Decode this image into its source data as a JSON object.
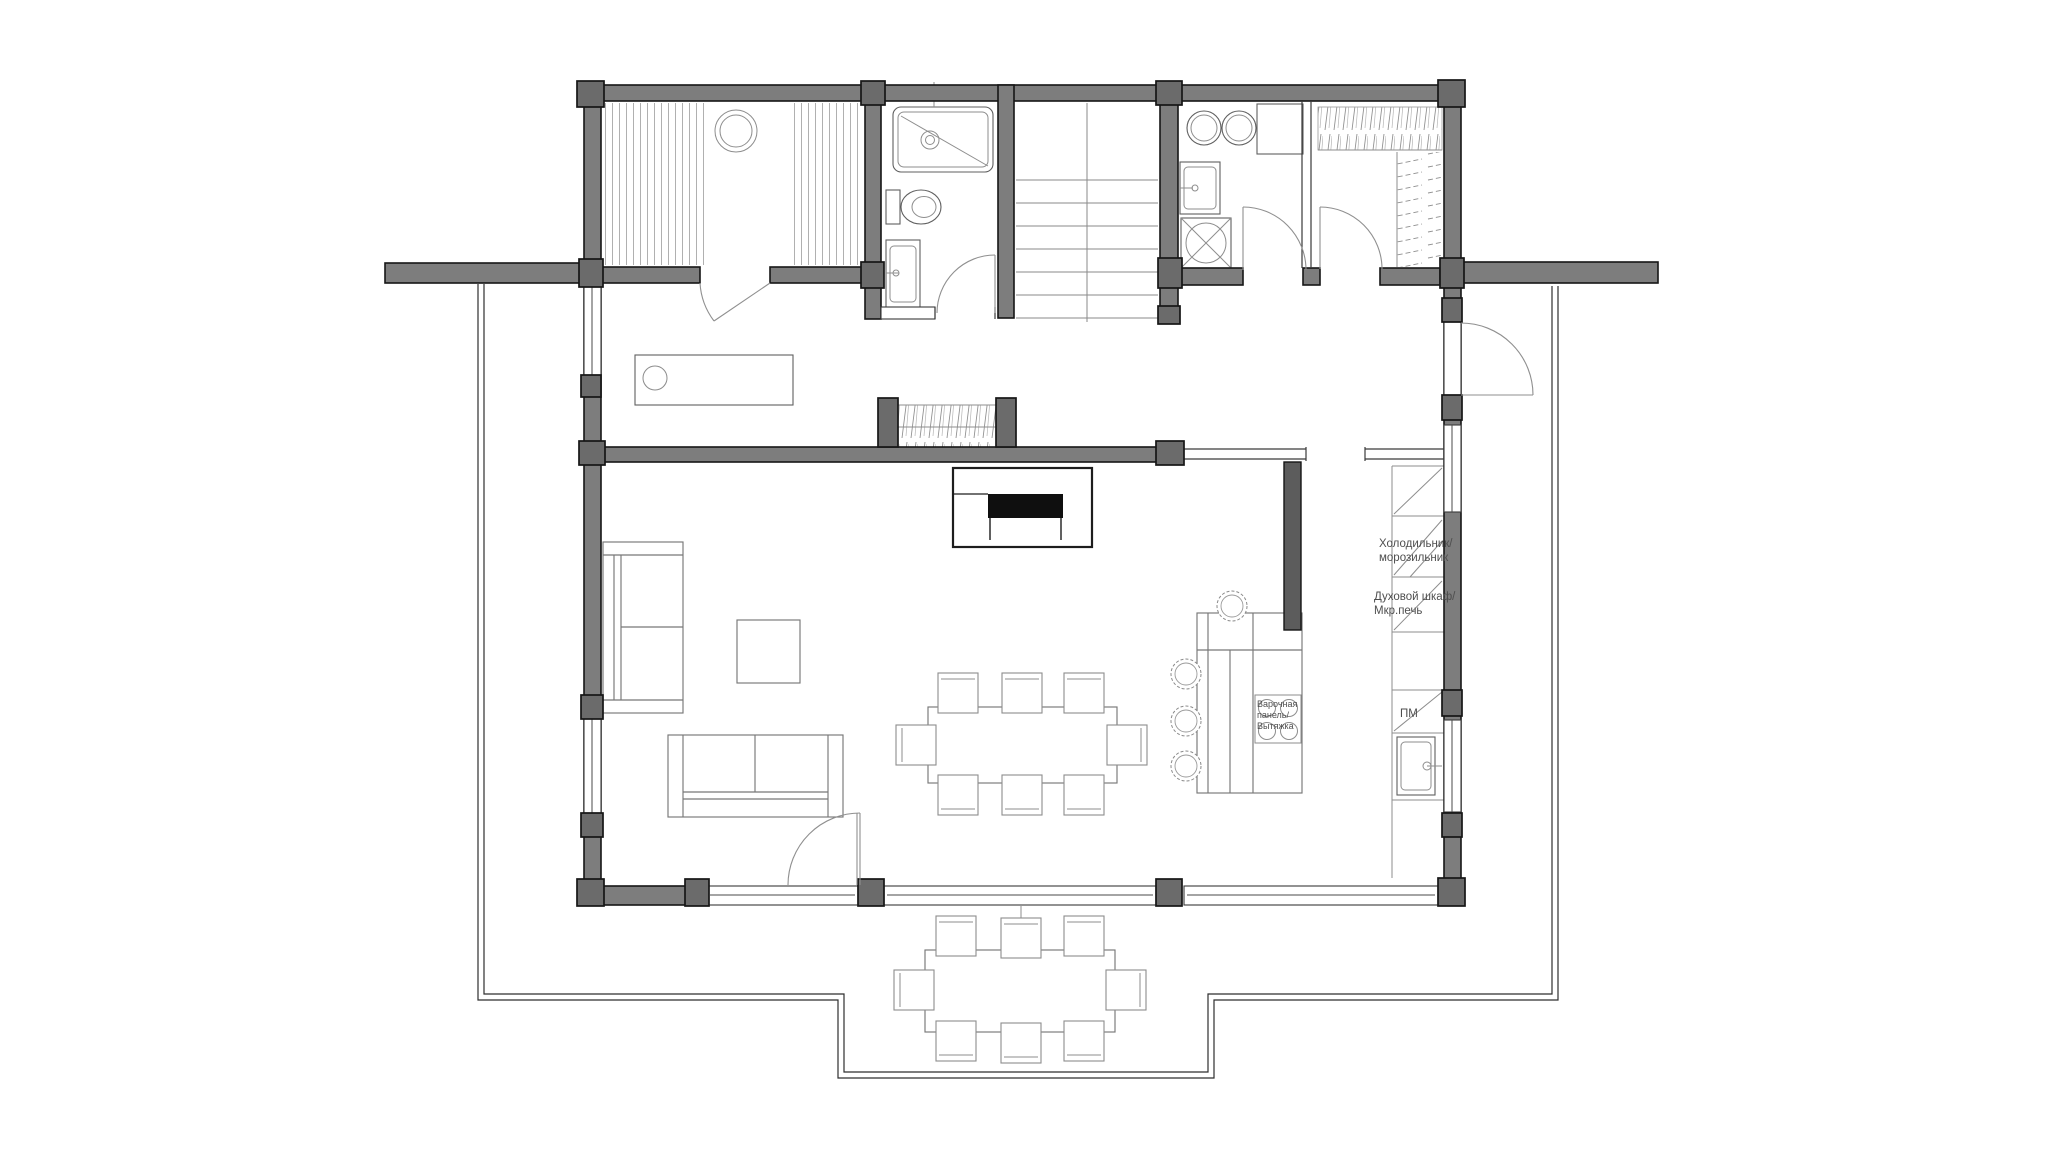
{
  "document": {
    "kind": "architectural-floor-plan",
    "background": "#ffffff"
  },
  "labels": {
    "fridge": {
      "line1": "Холодильник/",
      "line2": "морозильник"
    },
    "oven": {
      "line1": "Духовой шкаф/",
      "line2": "Мкр.печь"
    },
    "cooktop": {
      "line1": "Варочная",
      "line2": "панель/",
      "line3": "Вытяжка"
    },
    "dishwasher": "ПМ"
  },
  "colors": {
    "wall": "#7d7d7d",
    "post": "#6b6b6b",
    "stub": "#5c5c5c",
    "outline": "#161616",
    "furniture": "#777777",
    "fireplace": "#0f0f0f",
    "text": "#4e4e4e"
  }
}
